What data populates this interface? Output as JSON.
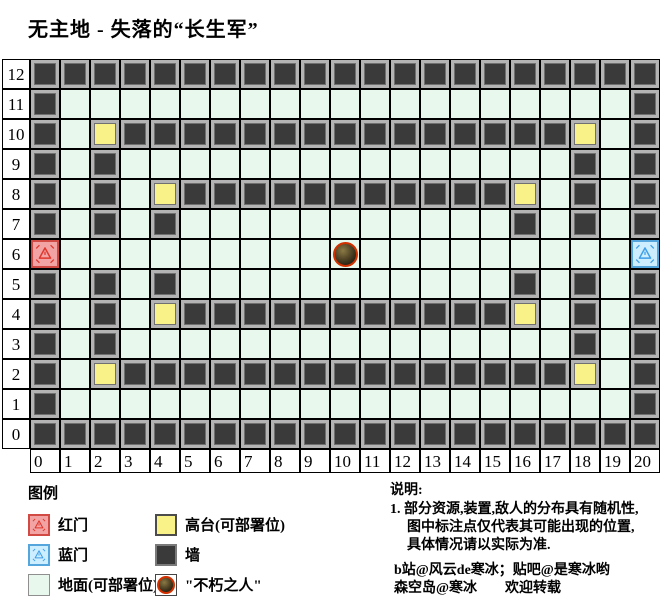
{
  "title": "无主地 - 失落的“长生军”",
  "grid": {
    "row_labels": [
      "12",
      "11",
      "10",
      "9",
      "8",
      "7",
      "6",
      "5",
      "4",
      "3",
      "2",
      "1",
      "0"
    ],
    "col_labels": [
      "0",
      "1",
      "2",
      "3",
      "4",
      "5",
      "6",
      "7",
      "8",
      "9",
      "10",
      "11",
      "12",
      "13",
      "14",
      "15",
      "16",
      "17",
      "18",
      "19",
      "20"
    ],
    "rows": [
      "WWWWWWWWWWWWWWWWWWWWW",
      "WGGGGGGGGGGGGGGGGGGGW",
      "WGHWWWWWWWWWWWWWWWHGW",
      "WGWGGGGGGGGGGGGGGGWGW",
      "WGWGHWWWWWWWWWWWHGWGW",
      "WGWGWGGGGGGGGGGGWGWGW",
      "RGGGGGGGGGIGGGGGGGGGB",
      "WGWGWGGGGGGGGGGGWGWGW",
      "WGWGHWWWWWWWWWWWHGWGW",
      "WGWGGGGGGGGGGGGGGGWGW",
      "WGHWWWWWWWWWWWWWWWHGW",
      "WGGGGGGGGGGGGGGGGGGGW",
      "WWWWWWWWWWWWWWWWWWWWW"
    ],
    "cell_codes": {
      "W": "wall",
      "G": "ground",
      "H": "platform",
      "R": "red-door",
      "B": "blue-door",
      "I": "immortal-on-ground"
    },
    "immortal_position": {
      "col": 10,
      "row": 6
    },
    "red_door_position": {
      "col": 0,
      "row": 6
    },
    "blue_door_position": {
      "col": 20,
      "row": 6
    }
  },
  "colors": {
    "ground": "#e8f8ec",
    "wall": "#3a3a3a",
    "platform": "#f9f289",
    "red_door_bg": "#f2a4a4",
    "red_accent": "#e0362c",
    "blue_door_bg": "#cdeeff",
    "blue_accent": "#3f9fe8",
    "immortal_ring": "#d33000"
  },
  "legend": {
    "heading": "图例",
    "items": [
      {
        "type": "red-door",
        "label": "红门"
      },
      {
        "type": "blue-door",
        "label": "蓝门"
      },
      {
        "type": "ground",
        "label": "地面(可部署位)"
      },
      {
        "type": "high",
        "label": "高台(可部署位)"
      },
      {
        "type": "wall",
        "label": "墙"
      },
      {
        "type": "immortal",
        "label": "\"不朽之人\""
      }
    ]
  },
  "notes": {
    "heading": "说明:",
    "line1": "1. 部分资源,装置,敌人的分布具有随机性,",
    "line2": "图中标注点仅代表其可能出现的位置,",
    "line3": "具体情况请以实际为准.",
    "credit1": "b站@风云de寒冰；贴吧@是寒冰哟",
    "credit2": "森空岛@寒冰　　欢迎转载"
  }
}
